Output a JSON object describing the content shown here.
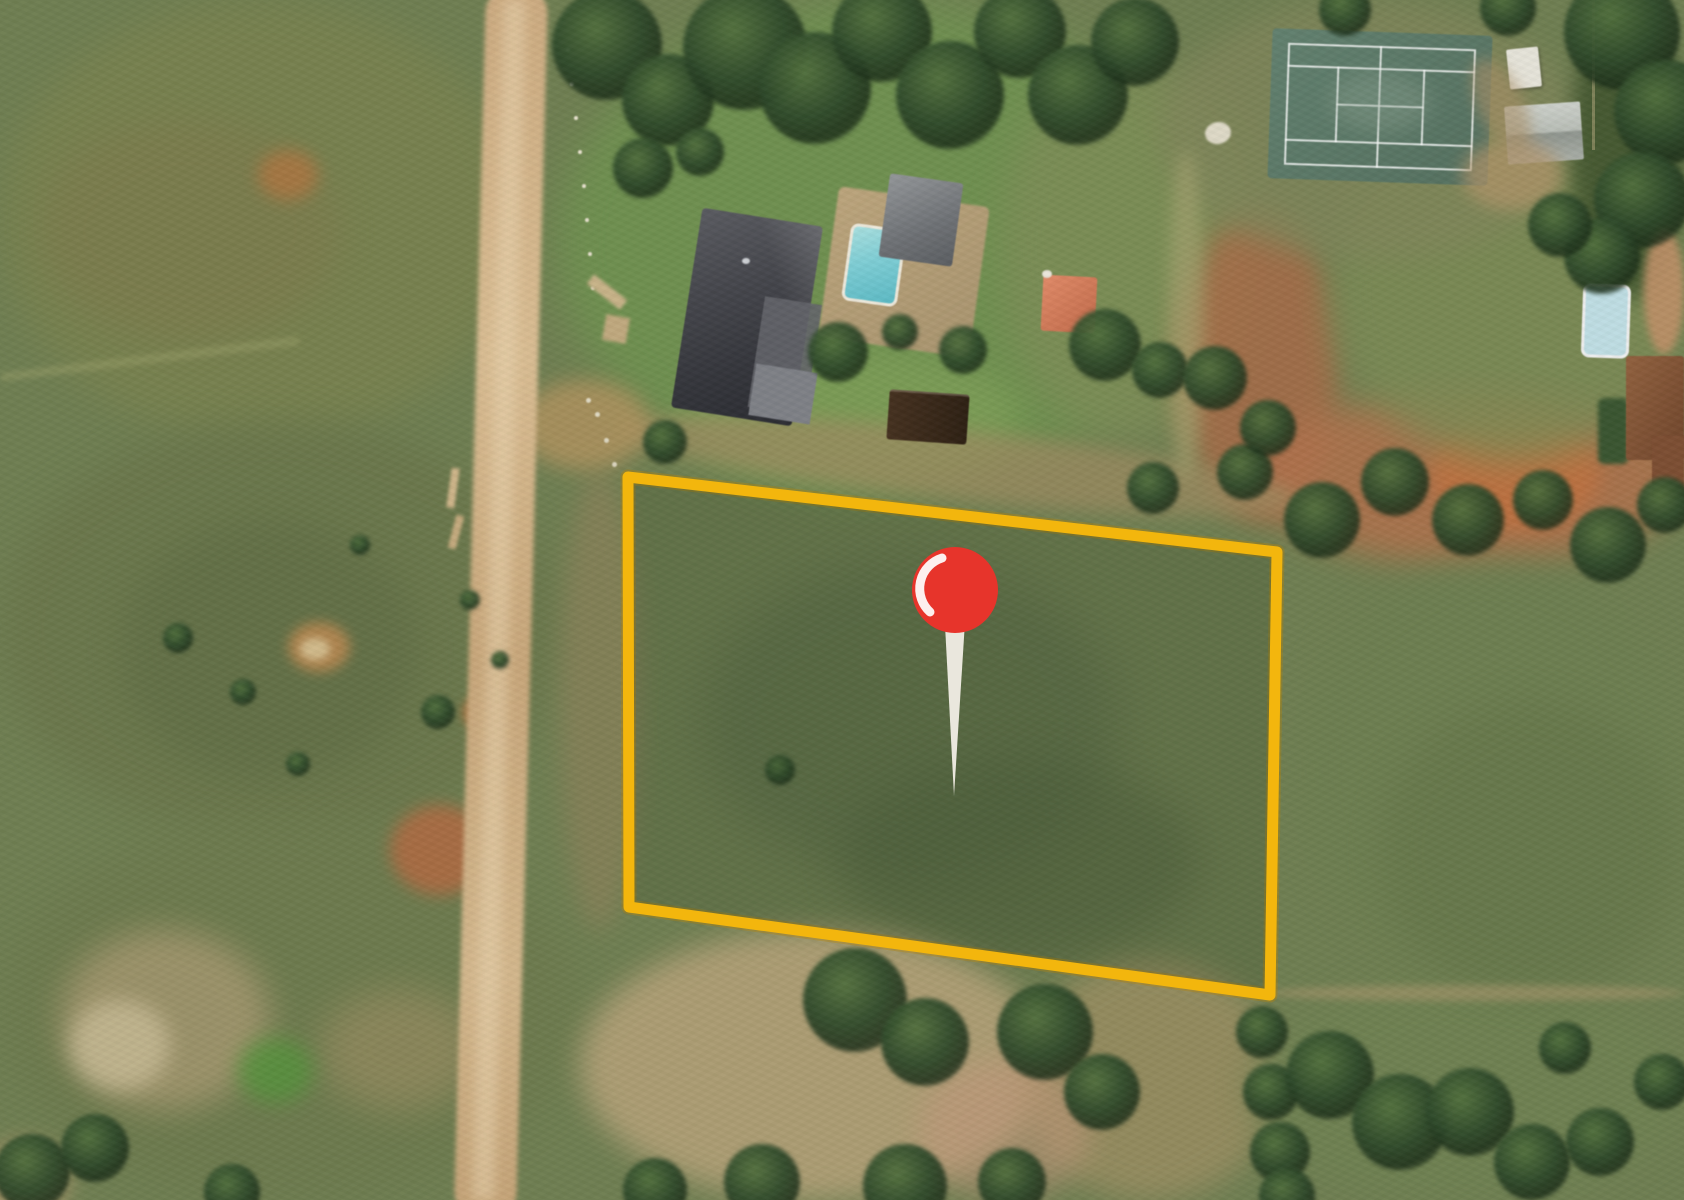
{
  "map_view": {
    "description": "Satellite aerial view of rural smallholdings with a highlighted vacant land plot and a red location pin",
    "boundary": {
      "points": "628,477 1277,552 1270,995 629,907",
      "color": "#F3B60D",
      "stroke_width": "11",
      "glow_color": "#B98300",
      "glow_width": "15",
      "fill": "rgba(28,48,22,0.16)"
    },
    "pin": {
      "head_cx": "955",
      "head_cy": "590",
      "head_r": "43",
      "head_color": "#E7342B",
      "needle_points": "944,606 966,606 954,796",
      "needle_color": "#EAE7DD",
      "highlight_path": "M 930 612 A 32 32 0 0 1 942 558",
      "highlight_color": "#FFFFFF",
      "highlight_width": "9"
    },
    "vegetation": {
      "trees": [
        [
          607,
          45,
          55
        ],
        [
          668,
          100,
          46
        ],
        [
          745,
          48,
          62
        ],
        [
          815,
          88,
          56
        ],
        [
          882,
          32,
          50
        ],
        [
          950,
          95,
          54
        ],
        [
          1020,
          32,
          46
        ],
        [
          1078,
          95,
          50
        ],
        [
          1135,
          42,
          44
        ],
        [
          643,
          168,
          30
        ],
        [
          700,
          152,
          24
        ],
        [
          838,
          352,
          30
        ],
        [
          900,
          332,
          18
        ],
        [
          963,
          350,
          24
        ],
        [
          1105,
          345,
          36
        ],
        [
          1160,
          370,
          28
        ],
        [
          665,
          442,
          22
        ],
        [
          1153,
          488,
          26
        ],
        [
          1245,
          472,
          28
        ],
        [
          1345,
          10,
          26
        ],
        [
          1215,
          378,
          32
        ],
        [
          1268,
          428,
          28
        ],
        [
          1322,
          520,
          38
        ],
        [
          1395,
          482,
          34
        ],
        [
          1468,
          520,
          36
        ],
        [
          1543,
          500,
          30
        ],
        [
          1608,
          545,
          38
        ],
        [
          1665,
          505,
          28
        ],
        [
          1622,
          32,
          58
        ],
        [
          1666,
          112,
          52
        ],
        [
          1642,
          200,
          48
        ],
        [
          1602,
          256,
          38
        ],
        [
          1560,
          225,
          32
        ],
        [
          1508,
          8,
          28
        ],
        [
          1262,
          1032,
          26
        ],
        [
          1271,
          1092,
          28
        ],
        [
          1280,
          1152,
          30
        ],
        [
          1287,
          1196,
          28
        ],
        [
          1330,
          1075,
          44
        ],
        [
          1400,
          1122,
          48
        ],
        [
          1470,
          1112,
          44
        ],
        [
          1532,
          1162,
          38
        ],
        [
          1600,
          1142,
          34
        ],
        [
          1662,
          1082,
          28
        ],
        [
          1565,
          1048,
          26
        ],
        [
          855,
          1000,
          52
        ],
        [
          925,
          1042,
          44
        ],
        [
          1045,
          1032,
          48
        ],
        [
          1102,
          1092,
          38
        ],
        [
          762,
          1182,
          38
        ],
        [
          905,
          1186,
          42
        ],
        [
          1012,
          1182,
          34
        ],
        [
          655,
          1190,
          32
        ],
        [
          32,
          1172,
          38
        ],
        [
          95,
          1148,
          34
        ],
        [
          232,
          1192,
          28
        ],
        [
          178,
          638,
          15
        ],
        [
          243,
          692,
          13
        ],
        [
          298,
          764,
          12
        ],
        [
          438,
          712,
          17
        ],
        [
          470,
          600,
          10
        ],
        [
          360,
          545,
          10
        ],
        [
          500,
          660,
          9
        ],
        [
          780,
          770,
          15
        ]
      ]
    }
  }
}
